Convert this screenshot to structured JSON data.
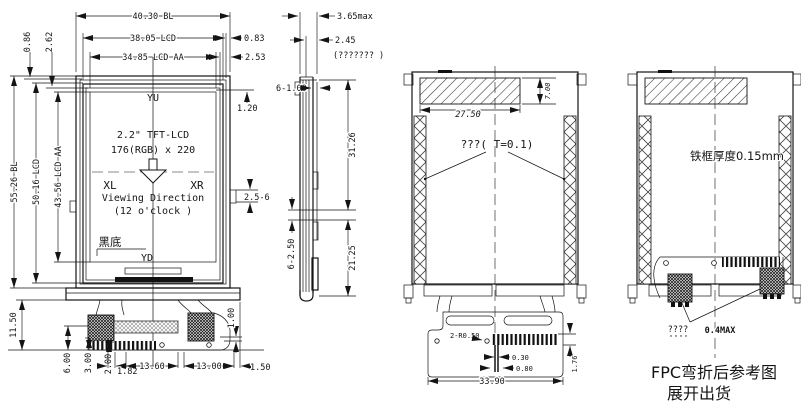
{
  "front": {
    "dim_width_bl": "40.30 BL",
    "dim_width_lcd": "38.05 LCD",
    "dim_width_aa": "34.85 LCD AA",
    "dim_edge_083": "0.83",
    "dim_edge_253": "2.53",
    "dim_edge_086": "0.86",
    "dim_edge_262": "2.62",
    "dim_inset_120": "1.20",
    "corner_yu": "YU",
    "corner_xl": "XL",
    "corner_xr": "XR",
    "corner_yd": "YD",
    "title_line1": "2.2\" TFT-LCD",
    "title_line2": "176(RGB) x 220",
    "viewing_line1": "Viewing Direction",
    "viewing_line2": "(12  o'clock )",
    "note_black": "黑底",
    "dim_height_bl": "55.26 BL",
    "dim_height_lcd": "50.16 LCD",
    "dim_height_aa": "43.56 LCD AA",
    "dim_pin_range": "2.5-6",
    "dim_fpc_1150": "11.50",
    "dim_fpc_600": "6.00",
    "dim_fpc_300": "3.00",
    "dim_fpc_200": "2.00",
    "dim_fpc_182": "1.82",
    "dim_fpc_1360": "13.60",
    "dim_fpc_1300": "13.00",
    "dim_fpc_150": "1.50",
    "dim_fpc_100": "1.00"
  },
  "side": {
    "dim_365": "3.65max",
    "dim_245": "2.45",
    "note": "(??????? )",
    "dim_6100": "6-1.00",
    "dim_3126": "31.26",
    "dim_6250": "6-2.50",
    "dim_2125": "21.25"
  },
  "back_open": {
    "dim_700": "7.00",
    "dim_2750": "27.50",
    "note_tape": "???( T=0.1)",
    "dim_holes": "2-R0.50",
    "dim_030": "0.30",
    "dim_080": "0.80",
    "dim_3390": "33.90",
    "dim_176": "1.76"
  },
  "back_fold": {
    "note_frame": "铁框厚度0.15mm",
    "note_q": "????",
    "dim_04max": "0.4MAX",
    "caption1": "FPC弯折后参考图",
    "caption2": "展开出货"
  }
}
